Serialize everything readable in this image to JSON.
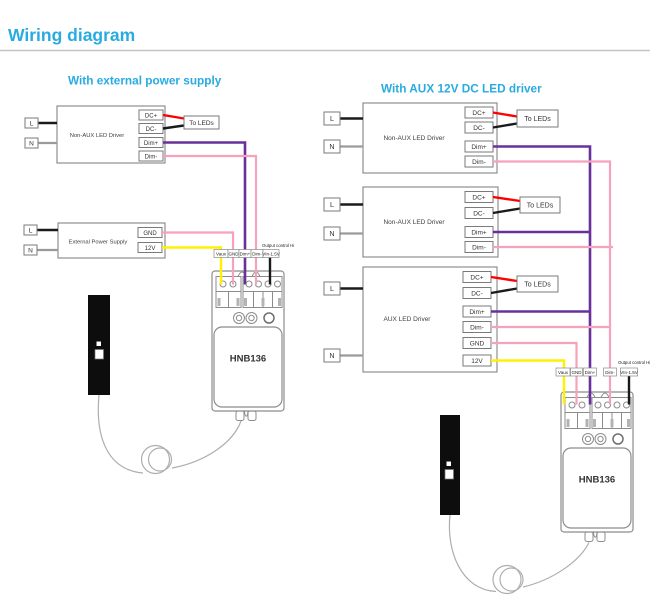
{
  "header": {
    "title": "Wiring diagram"
  },
  "colors": {
    "accent": "#29abe2",
    "box_border": "#848484",
    "wire_red": "#ff0000",
    "wire_black": "#1a1a1a",
    "wire_purple": "#68309b",
    "wire_pink": "#f5a2ba",
    "wire_yellow": "#fff200",
    "wire_neutral_gray": "#9a9a9a",
    "sensor_black": "#0d0d0d"
  },
  "left": {
    "subtitle": "With external power supply",
    "driver": {
      "label": "Non-AUX LED Driver",
      "input_l": "L",
      "input_n": "N",
      "pin_dc_plus": "DC+",
      "pin_dc_minus": "DC-",
      "pin_dim_plus": "Dim+",
      "pin_dim_minus": "Dim-",
      "leds": "To LEDs"
    },
    "psu": {
      "label": "External Power Supply",
      "input_l": "L",
      "input_n": "N",
      "pin_gnd": "GND",
      "pin_12v": "12V"
    },
    "controller": {
      "model": "HNB136",
      "output_note": "Output control Hi",
      "pins": [
        "Vaux",
        "GND",
        "Dim+",
        "Dim-",
        "VIn-1.5V"
      ]
    }
  },
  "right": {
    "subtitle": "With AUX 12V DC LED driver",
    "driver1": {
      "label": "Non-AUX LED Driver",
      "input_l": "L",
      "input_n": "N",
      "pin_dc_plus": "DC+",
      "pin_dc_minus": "DC-",
      "pin_dim_plus": "Dim+",
      "pin_dim_minus": "Dim-",
      "leds": "To LEDs"
    },
    "driver2": {
      "label": "Non-AUX LED Driver",
      "input_l": "L",
      "input_n": "N",
      "pin_dc_plus": "DC+",
      "pin_dc_minus": "DC-",
      "pin_dim_plus": "Dim+",
      "pin_dim_minus": "Dim-",
      "leds": "To LEDs"
    },
    "aux_driver": {
      "label": "AUX LED Driver",
      "input_l": "L",
      "input_n": "N",
      "pin_dc_plus": "DC+",
      "pin_dc_minus": "DC-",
      "pin_dim_plus": "Dim+",
      "pin_dim_minus": "Dim-",
      "pin_gnd": "GND",
      "pin_12v": "12V",
      "leds": "To LEDs"
    },
    "controller": {
      "model": "HNB136",
      "output_note": "Output control Hi",
      "pins": [
        "Vaux",
        "GND",
        "Dim+",
        "Dim-",
        "VIn-1.5V"
      ]
    }
  }
}
